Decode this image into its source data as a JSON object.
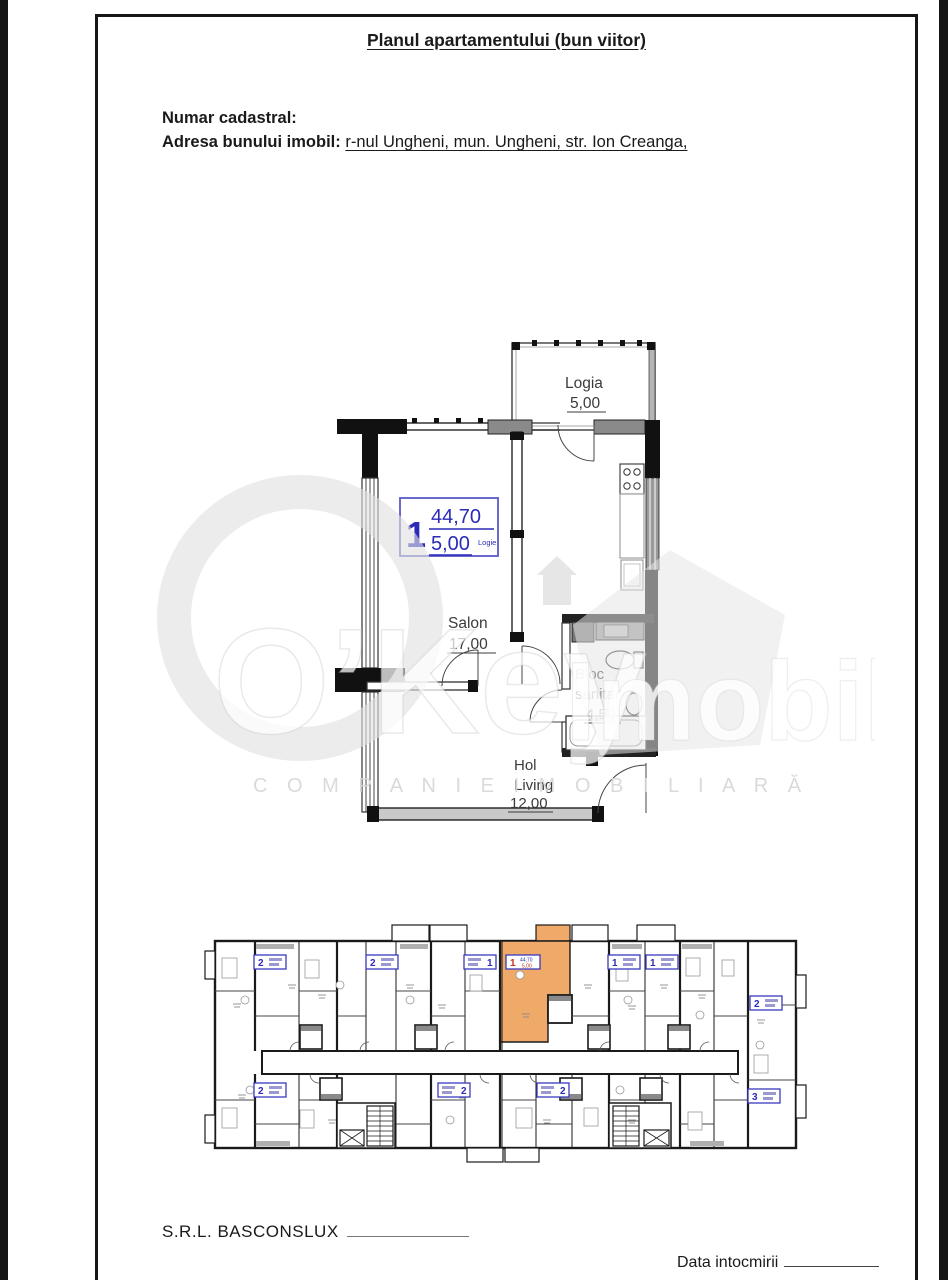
{
  "page": {
    "title": "Planul apartamentului (bun viitor)",
    "cadastral_label": "Numar cadastral:",
    "address_label": "Adresa bunului imobil:",
    "address_value": "r-nul Ungheni, mun. Ungheni, str. Ion Creanga,"
  },
  "apartment_plan": {
    "info_box": {
      "number": "1",
      "total_area": "44,70",
      "logia_area": "5,00",
      "logia_caption": "Logie"
    },
    "rooms": {
      "logia": {
        "name": "Logia",
        "area": "5,00"
      },
      "salon": {
        "name": "Salon",
        "area": "17,00"
      },
      "bloc": {
        "line1": "Bloc",
        "line2": "sanitar",
        "area": "4,50"
      },
      "hol": {
        "line1": "Hol",
        "line2": "Living",
        "area": "12,00"
      }
    }
  },
  "watermark": {
    "brand_left": "O’Key",
    "brand_right": "Imobil",
    "tagline": "C O M P A N I E   I M O B I L I A R Ă"
  },
  "floor_plan": {
    "badges": [
      "2",
      "2",
      "1",
      "1",
      "1",
      "2",
      "2",
      "2",
      "2",
      "3"
    ],
    "highlighted_badge": {
      "number": "1",
      "area_top": "44,70",
      "area_bottom": "5,00"
    },
    "highlight_color": "#efa968"
  },
  "footer": {
    "company": "S.R.L. BASCONSLUX",
    "date_label": "Data intocmirii"
  },
  "colors": {
    "plan_blue": "#2b2bb8",
    "badge_red": "#c5311f",
    "highlight_orange": "#efa968"
  }
}
